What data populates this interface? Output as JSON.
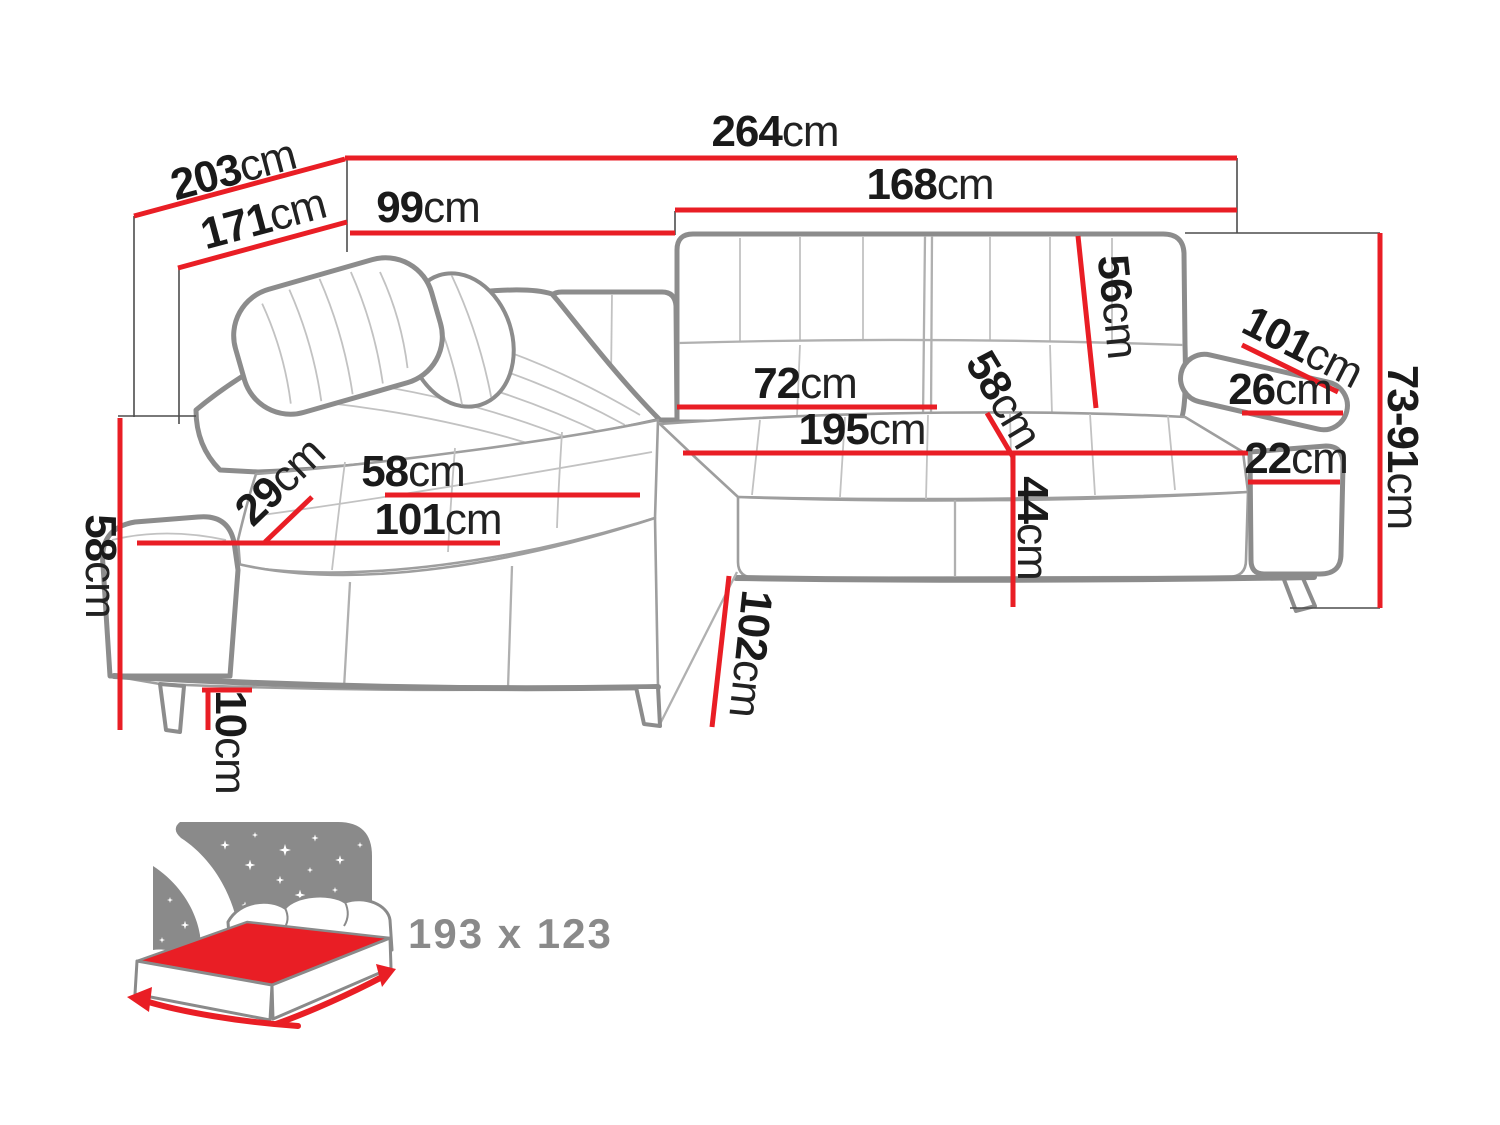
{
  "diagram": {
    "kind": "corner-sofa-dimension-diagram",
    "unit": "cm",
    "colors": {
      "dimension_red": "#e91e25",
      "sofa_outline_gray": "#8c8c8c",
      "seam_gray": "#c2c2c2",
      "label_black": "#1a1a1a",
      "icon_gray": "#8a8a8a"
    },
    "dimensions": {
      "depth_outer": {
        "value": "203",
        "unit": "cm"
      },
      "depth_inner": {
        "value": "171",
        "unit": "cm"
      },
      "width_total": {
        "value": "264",
        "unit": "cm"
      },
      "back_left_width": {
        "value": "99",
        "unit": "cm"
      },
      "back_right_width": {
        "value": "168",
        "unit": "cm"
      },
      "backrest_height": {
        "value": "56",
        "unit": "cm"
      },
      "armrest_length": {
        "value": "101",
        "unit": "cm"
      },
      "armrest_top_width": {
        "value": "26",
        "unit": "cm"
      },
      "height_range": {
        "value": "73-91",
        "unit": "cm"
      },
      "seat_back_width": {
        "value": "72",
        "unit": "cm"
      },
      "seat_depth_mid": {
        "value": "58",
        "unit": "cm"
      },
      "seat_width": {
        "value": "195",
        "unit": "cm"
      },
      "armrest_front_width": {
        "value": "22",
        "unit": "cm"
      },
      "seat_height": {
        "value": "44",
        "unit": "cm"
      },
      "chaise_seat_depth": {
        "value": "58",
        "unit": "cm"
      },
      "armrest_width": {
        "value": "29",
        "unit": "cm"
      },
      "chaise_front_width": {
        "value": "101",
        "unit": "cm"
      },
      "side_height": {
        "value": "58",
        "unit": "cm"
      },
      "leg_height": {
        "value": "10",
        "unit": "cm"
      },
      "chaise_length": {
        "value": "102",
        "unit": "cm"
      }
    },
    "bed": {
      "sleeping_area": "193 x 123"
    }
  }
}
